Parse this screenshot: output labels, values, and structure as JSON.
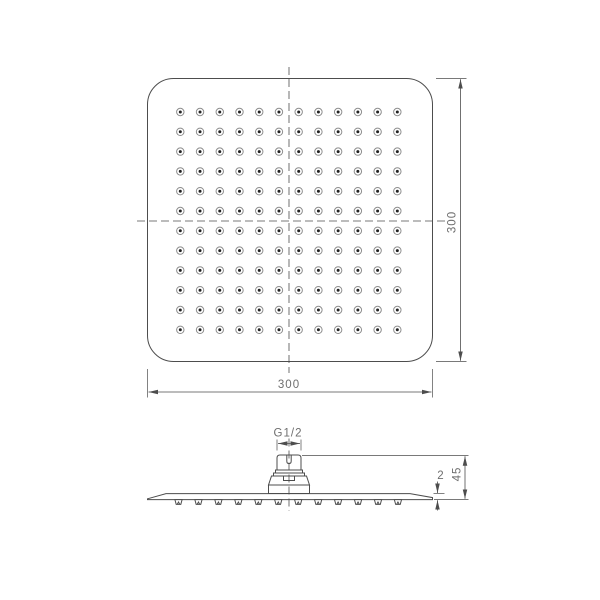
{
  "colors": {
    "background": "#ffffff",
    "line": "#4d4d4d",
    "text": "#6e6e6e",
    "nozzle_ring": "#8d8d8d",
    "nozzle_dot": "#222222"
  },
  "top_view": {
    "width_label": "300",
    "height_label": "300",
    "nozzle_grid": {
      "rows": 12,
      "cols": 12
    }
  },
  "side_view": {
    "thread_label": "G1/2",
    "plate_thickness_label": "2",
    "height_label": "45",
    "nozzle_count": 12
  }
}
